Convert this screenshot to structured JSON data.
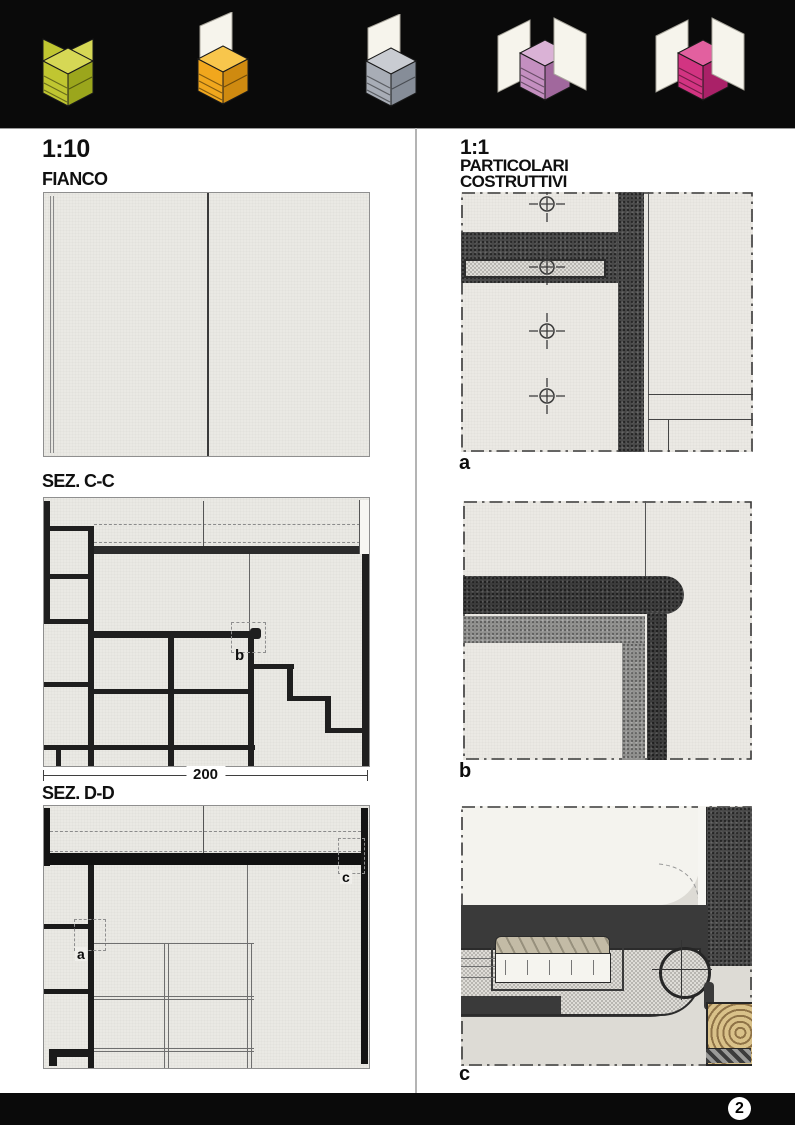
{
  "page": {
    "background": "#ffffff",
    "band_color": "#0a0a0a",
    "page_number": "2"
  },
  "header": {
    "panel_color": "#f6f4ec",
    "figures": [
      {
        "name": "assembly-stage-1",
        "top": "#d6d855",
        "left": "#c0c631",
        "right": "#9ba61c"
      },
      {
        "name": "assembly-stage-2",
        "top": "#f8c64c",
        "left": "#f1a71d",
        "right": "#cf8a10"
      },
      {
        "name": "assembly-stage-3",
        "top": "#c9ccd2",
        "left": "#a8adb6",
        "right": "#868d98"
      },
      {
        "name": "assembly-stage-4",
        "top": "#dab2d6",
        "left": "#c48fc0",
        "right": "#a1689d"
      },
      {
        "name": "assembly-stage-5",
        "top": "#e2609f",
        "left": "#d23482",
        "right": "#aa2168"
      }
    ]
  },
  "left_column": {
    "scale_label": "1:10",
    "fianco_title": "FIANCO",
    "sez_cc_title": "SEZ. C-C",
    "sez_cc_callout": "b",
    "dimension": "200",
    "sez_dd_title": "SEZ. D-D",
    "sez_dd_callout_a": "a",
    "sez_dd_callout_c": "c"
  },
  "right_column": {
    "scale_label": "1:1",
    "title_line1": "PARTICOLARI",
    "title_line2": "COSTRUTTIVI",
    "detail_a": "a",
    "detail_b": "b",
    "detail_c": "c"
  }
}
